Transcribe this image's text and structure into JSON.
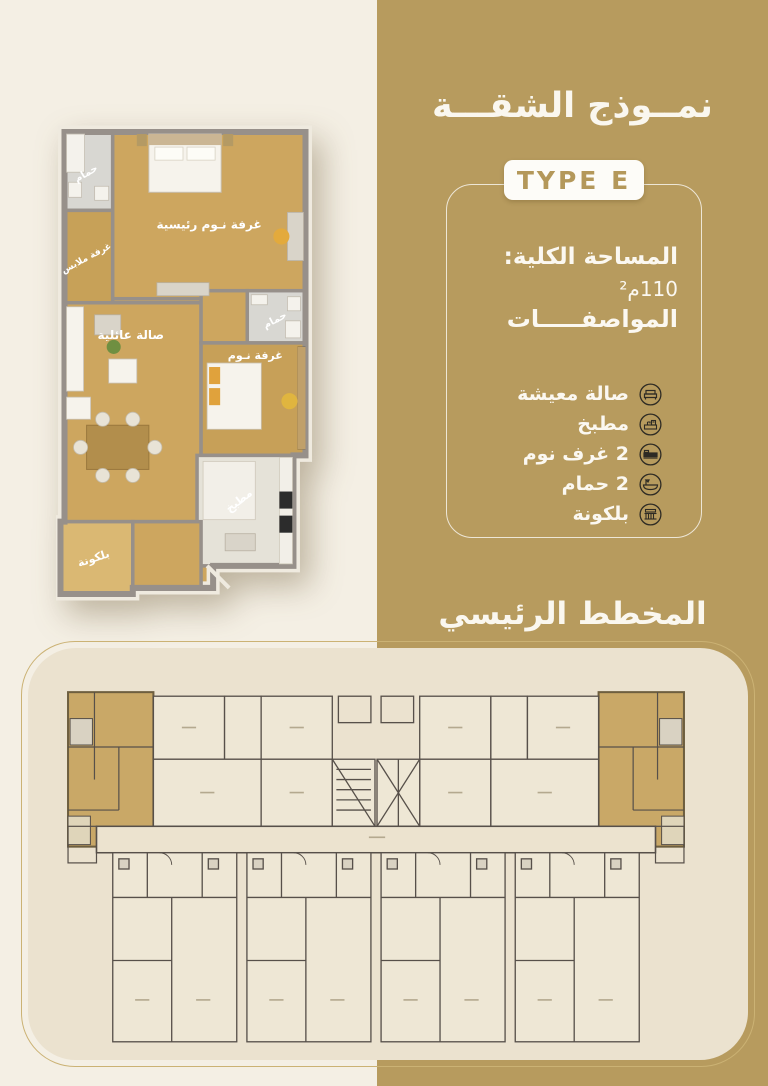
{
  "colors": {
    "gold": "#b79b5e",
    "page_bg": "#f4efe4",
    "panel_cream": "#ebe2cf",
    "badge_text_gold": "#b4985a",
    "icon_dark": "#2e2b24",
    "wood_floor": "#cda65f",
    "highlight_unit": "#c9a867",
    "white_text": "#fbf8f1"
  },
  "right_panel": {
    "title": "نمــوذج الشقـــة",
    "type_label": "TYPE E",
    "area_label": "المساحة الكلية:",
    "area_value": "110م²",
    "specs_title": "المواصفـــــات",
    "specs": [
      {
        "icon": "sofa-icon",
        "label": "صالة معيشة"
      },
      {
        "icon": "kitchen-icon",
        "label": "مطبخ"
      },
      {
        "icon": "bed-icon",
        "label": "2 غرف نوم"
      },
      {
        "icon": "bathtub-icon",
        "label": "2 حمام"
      },
      {
        "icon": "balcony-icon",
        "label": "بلكونة"
      }
    ],
    "master_plan_title": "المخطط الرئيسي"
  },
  "apartment_plan": {
    "rooms": [
      {
        "name": "bathroom-1",
        "label": "حمام"
      },
      {
        "name": "dressing-room",
        "label": "غرفة ملابس"
      },
      {
        "name": "master-bedroom",
        "label": "غرفة نـوم رئيسية"
      },
      {
        "name": "family-hall",
        "label": "صالة عائلية"
      },
      {
        "name": "bathroom-2",
        "label": "حمام"
      },
      {
        "name": "bedroom",
        "label": "غرفة نـوم"
      },
      {
        "name": "kitchen",
        "label": "مطبخ"
      },
      {
        "name": "balcony",
        "label": "بلكونة"
      }
    ]
  }
}
